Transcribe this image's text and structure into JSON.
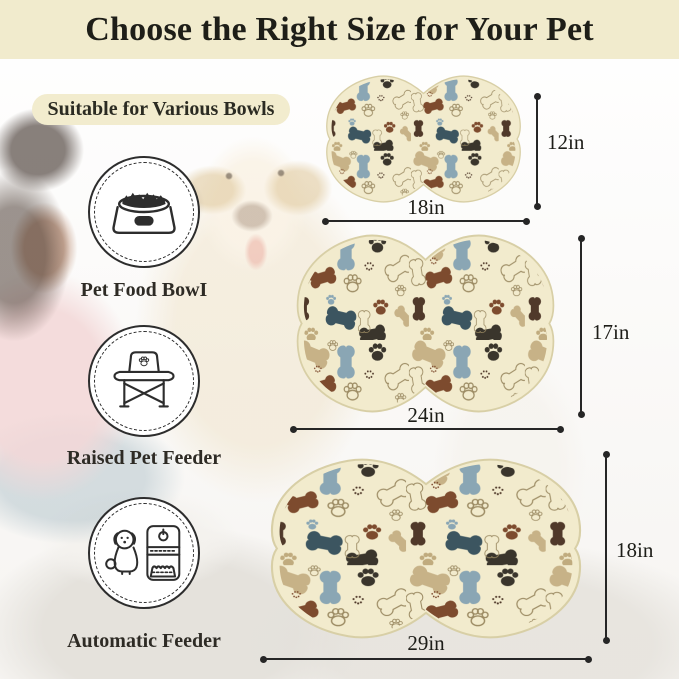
{
  "banner": {
    "title": "Choose the Right Size for Your Pet"
  },
  "badge": {
    "label": "Suitable for Various Bowls"
  },
  "feeders": [
    {
      "label": "Pet Food BowI",
      "icon": "pet-food-bowl-icon"
    },
    {
      "label": "Raised Pet Feeder",
      "icon": "raised-pet-feeder-icon"
    },
    {
      "label": "Automatic Feeder",
      "icon": "automatic-feeder-icon"
    }
  ],
  "mats": [
    {
      "name": "small",
      "width_label": "18in",
      "height_label": "12in"
    },
    {
      "name": "medium",
      "width_label": "24in",
      "height_label": "17in"
    },
    {
      "name": "large",
      "width_label": "29in",
      "height_label": "18in"
    }
  ],
  "colors": {
    "banner_bg": "#f1ebcd",
    "badge_bg": "#f2ecce",
    "text_dark": "#1e1e18",
    "mat_base": "#f2ebcd",
    "mat_border": "#d8cfa6",
    "pattern_slate_blue": "#8aa6b4",
    "pattern_tan": "#c7b287",
    "pattern_dark_brown": "#50392a",
    "pattern_red_brown": "#7d4b2e",
    "pattern_teal": "#3c5560",
    "pattern_charcoal": "#3a352c",
    "pattern_outline": "#9b8a62",
    "dimension_line": "#262626"
  }
}
